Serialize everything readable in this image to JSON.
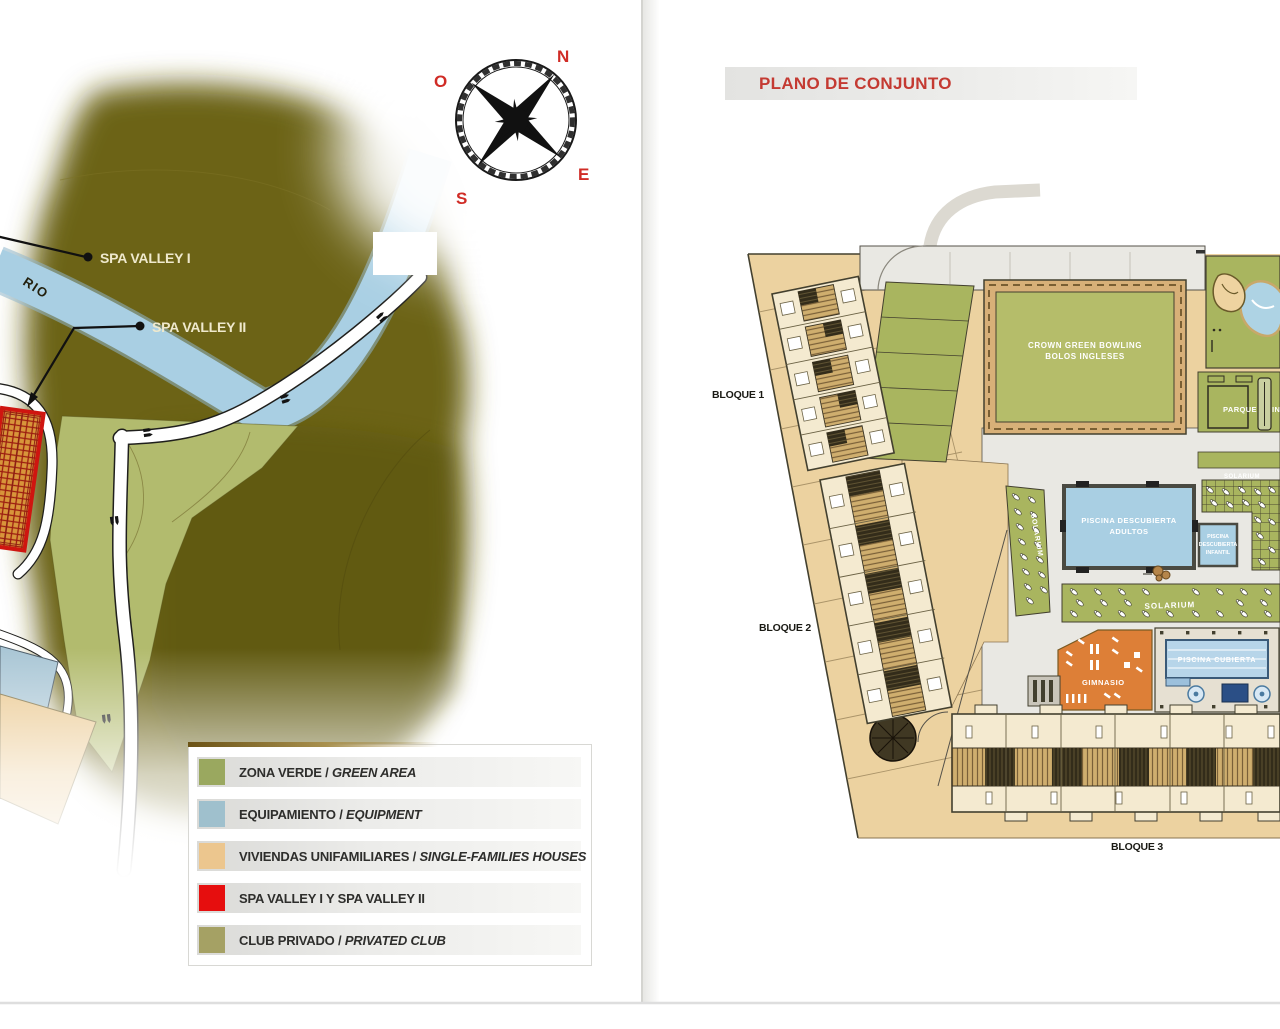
{
  "left_map": {
    "rio": "RIO",
    "spa_valley_1": "SPA VALLEY I",
    "spa_valley_2": "SPA VALLEY II",
    "compass": {
      "n": "N",
      "e": "E",
      "s": "S",
      "o": "O"
    },
    "legend": {
      "items": [
        {
          "es": "ZONA VERDE / ",
          "en": "GREEN AREA",
          "swatch": "#9aa85f"
        },
        {
          "es": "EQUIPAMIENTO / ",
          "en": "EQUIPMENT",
          "swatch": "#9fc0cd"
        },
        {
          "es": "VIVIENDAS UNIFAMILIARES / ",
          "en": "SINGLE-FAMILIES HOUSES",
          "swatch": "#ecc68e"
        },
        {
          "es": "SPA VALLEY I Y SPA VALLEY II",
          "en": "",
          "swatch": "#e60e0e"
        },
        {
          "es": "CLUB PRIVADO / ",
          "en": "PRIVATED CLUB",
          "swatch": "#a5a164"
        }
      ]
    }
  },
  "right_plan": {
    "title": "PLANO DE CONJUNTO",
    "bloque_1": "BLOQUE 1",
    "bloque_2": "BLOQUE 2",
    "bloque_3": "BLOQUE 3",
    "bowling_1": "CROWN GREEN BOWLING",
    "bowling_2": "BOLOS INGLESES",
    "parque_1": "PARQUE",
    "parque_2": "INFANTIL",
    "solarium": "SOLARIUM",
    "piscina_adultos_1": "PISCINA DESCUBIERTA",
    "piscina_adultos_2": "ADULTOS",
    "piscina_infantil_1": "PISCINA",
    "piscina_infantil_2": "DESCUBIERTA",
    "piscina_infantil_3": "INFANTIL",
    "piscina_cubierta": "PISCINA CUBIERTA",
    "gimnasio": "GIMNASIO"
  },
  "colors": {
    "accent_red": "#c43a32",
    "terrain_olive": "#6c6318",
    "river_blue": "#a9cfe3",
    "zone_green": "#9aa85f",
    "equipment_blue": "#9fc0cd",
    "houses_tan": "#ecc68e",
    "spa_red": "#e60e0e",
    "club_olive": "#a5a164",
    "amenity_green": "#a9b55f",
    "pool_blue": "#a9cfe3",
    "gym_orange": "#dd7f37"
  }
}
